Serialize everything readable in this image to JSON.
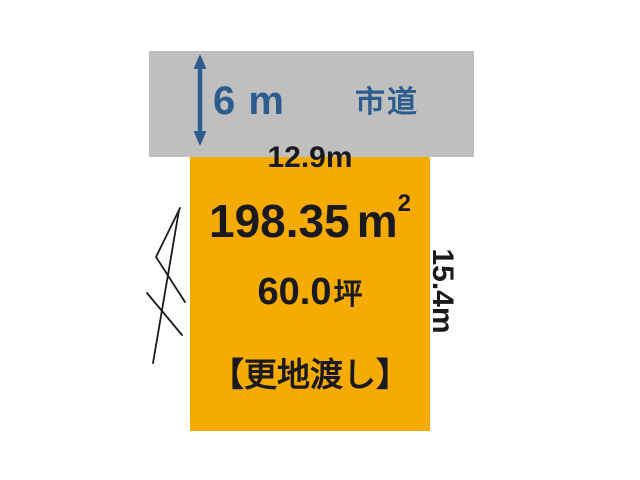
{
  "colors": {
    "road_fill": "#bfbfbf",
    "land_fill": "#f6ab00",
    "accent_blue": "#2c5d8e",
    "ink": "#1a1a1a",
    "background": "#ffffff"
  },
  "road": {
    "name": "市道",
    "width_label": "6 m"
  },
  "land": {
    "frontage": "12.9m",
    "depth": "15.4m",
    "area_sqm_value": "198.35",
    "area_sqm_unit": "m",
    "area_sqm_exponent": "2",
    "area_tsubo_value": "60.0",
    "area_tsubo_unit": "坪",
    "condition": "【更地渡し】"
  }
}
